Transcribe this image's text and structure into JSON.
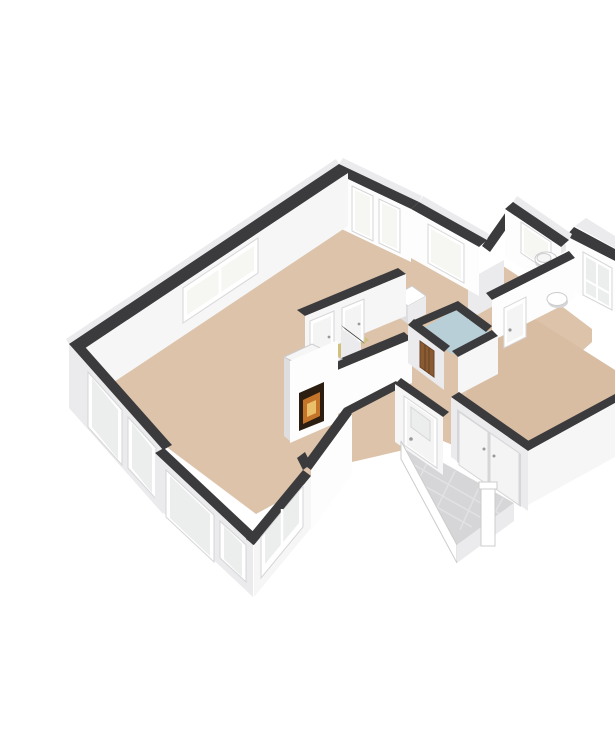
{
  "figure": {
    "kind": "isometric-3d-floorplan-render",
    "background": "#ffffff",
    "rooms": [
      {
        "id": "living-room",
        "floor_color_key": "flLiving",
        "features": [
          "double-window-nw",
          "two-french-windows-ne",
          "fireplace",
          "bay-windows-sw"
        ]
      },
      {
        "id": "hallway",
        "floor_color_key": "flLiving",
        "features": [
          "bevel-window",
          "cabinet"
        ]
      },
      {
        "id": "closet-a",
        "floor_color_key": "flYellow",
        "features": [
          "door"
        ]
      },
      {
        "id": "closet-b",
        "floor_color_key": "flYellow",
        "features": [
          "door"
        ]
      },
      {
        "id": "bathroom",
        "floor_color_key": "flBath",
        "features": [
          "radiator"
        ]
      },
      {
        "id": "toilet-room",
        "floor_color_key": "flWC",
        "features": [
          "toilet",
          "window"
        ]
      },
      {
        "id": "bedroom",
        "floor_color_key": "flBed",
        "features": [
          "glazed-balcony-door",
          "door",
          "wash-basin"
        ]
      },
      {
        "id": "entrance-landing",
        "floor_color_key": "flTile",
        "features": [
          "front-door",
          "wardrobe-doors",
          "newel-post",
          "open-stair-edge"
        ]
      }
    ],
    "palette": {
      "cap": "#3b3b3d",
      "wWhite": "#fdfdfd",
      "wBright": "#f6f6f7",
      "wMid": "#ebebed",
      "wShade": "#dedee0",
      "wDark": "#cfcfd2",
      "flLiving": "#dcc3aa",
      "flBed": "#d9bda3",
      "flWC": "#e8e8e8",
      "flBath": "#b9cfd7",
      "flYellow": "#d0c07b",
      "flTile": "#d6d6d8",
      "tileLine": "#e2e2e4",
      "glass": "#f6f6f2",
      "glassCool": "#eceeee",
      "frame": "#ffffff",
      "frameSh": "#d6d6d8",
      "door": "#f4f4f4",
      "handle": "#999999",
      "fireDark": "#2c1f12",
      "fireOr": "#c4752a",
      "fireYe": "#eac06a",
      "brown": "#8a5a33",
      "brownD": "#6b4526",
      "white": "#ffffff",
      "edge": "#cccccc"
    }
  }
}
